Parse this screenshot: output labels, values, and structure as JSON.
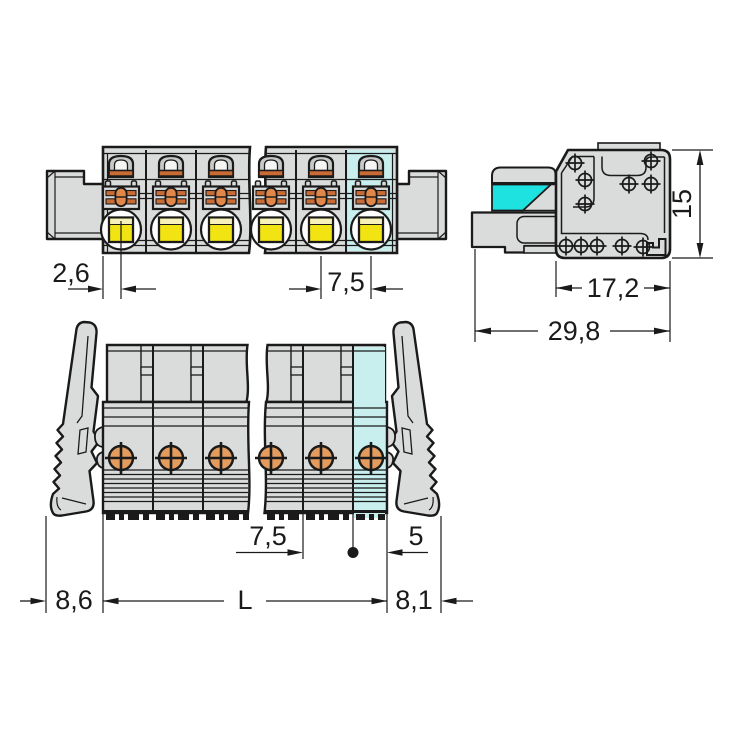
{
  "drawing": {
    "kind": "terminal-block-connector dimension drawing",
    "views": 3
  },
  "dimensions": {
    "front_edge_offset": "2,6",
    "front_pitch": "7,5",
    "side_height": "15",
    "side_depth_body": "17,2",
    "side_depth_total": "29,8",
    "bottom_pitch": "7,5",
    "bottom_end_offset": "5",
    "bottom_left_overhang": "8,6",
    "bottom_length": "L",
    "bottom_right_overhang": "8,1"
  },
  "colors": {
    "outline_ink": "#1a1a1a",
    "body_gray": "#dadcdb",
    "body_gray_dark": "#c7cac9",
    "contact_orange": "#c96b35",
    "contact_orange_light": "#e2874a",
    "contact_pad_orange": "#e49b5e",
    "button_yellow": "#f2e413",
    "button_yellow_pale": "#f6f0bb",
    "pole_highlight_cyan": "#c9eeee",
    "lever_cyan": "#1ee2e0"
  }
}
